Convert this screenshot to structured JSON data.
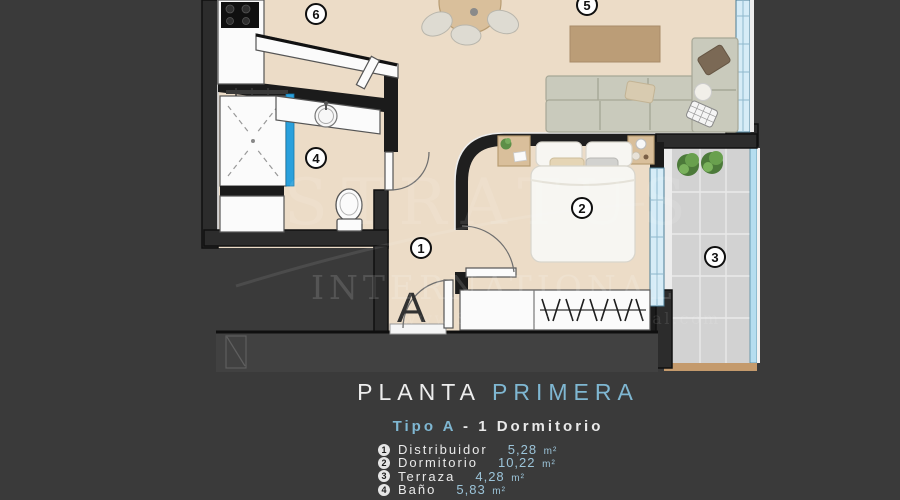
{
  "colors": {
    "background": "#3a3a3a",
    "accent": "#7fb7d2",
    "title": "#ededed",
    "floor": "#ecdcc7",
    "wall": "#262626",
    "shower_glass": "#2aa0dc",
    "window": "#d6ecf7",
    "terrace": "#d2d2d2",
    "legend_value": "#9cc4d9"
  },
  "watermark": {
    "brand_top": "STRATUS",
    "brand_bottom": "INTERNATIONAL",
    "website": "www.StratusInternational.com"
  },
  "plan": {
    "unit_label": "A",
    "badges": [
      {
        "n": "6",
        "x": 316,
        "y": 14
      },
      {
        "n": "5",
        "x": 587,
        "y": 5
      },
      {
        "n": "4",
        "x": 316,
        "y": 158
      },
      {
        "n": "2",
        "x": 582,
        "y": 208
      },
      {
        "n": "1",
        "x": 421,
        "y": 248
      },
      {
        "n": "3",
        "x": 715,
        "y": 257
      }
    ]
  },
  "title": {
    "main_left": "PLANTA",
    "main_right": "PRIMERA",
    "sub_accent": "Tipo A",
    "sub_rest": "- 1 Dormitorio"
  },
  "legend": {
    "rooms": [
      {
        "number": "1",
        "name": "Distribuidor",
        "area": "5,28",
        "unit": "m²"
      },
      {
        "number": "2",
        "name": "Dormitorio",
        "area": "10,22",
        "unit": "m²"
      },
      {
        "number": "3",
        "name": "Terraza",
        "area": "4,28",
        "unit": "m²"
      },
      {
        "number": "4",
        "name": "Baño",
        "area": "5,83",
        "unit": "m²"
      }
    ]
  }
}
